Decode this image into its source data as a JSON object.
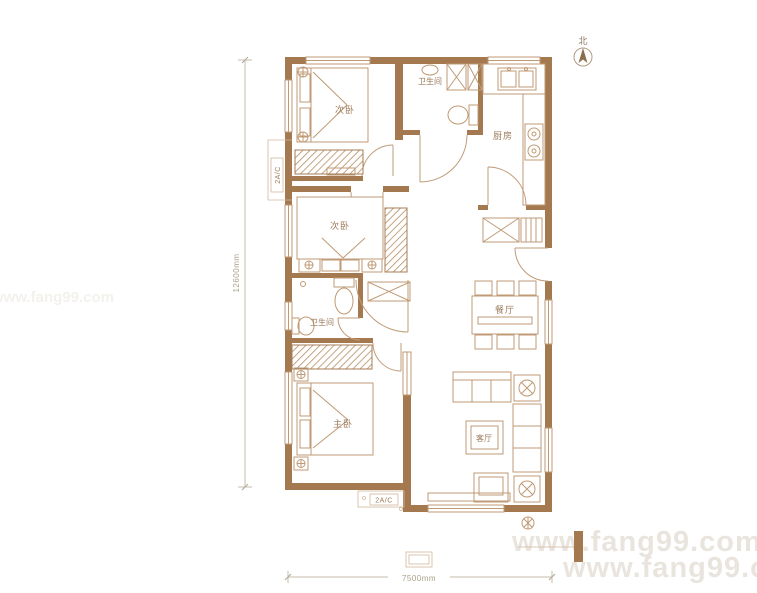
{
  "compass": {
    "label": "北"
  },
  "rooms": {
    "bedroom_top": {
      "label": "次卧"
    },
    "bathroom_top": {
      "label": "卫生间"
    },
    "kitchen": {
      "label": "厨房"
    },
    "bedroom_mid": {
      "label": "次卧"
    },
    "bathroom_mid": {
      "label": "卫生间"
    },
    "master_bedroom": {
      "label": "主卧"
    },
    "dining_room": {
      "label": "餐厅"
    },
    "living_room": {
      "label": "客厅"
    }
  },
  "annotations": {
    "ac_left": "2A/C",
    "ac_bottom": "2A/C"
  },
  "dimensions": {
    "vertical": "12600mm",
    "horizontal": "7500mm"
  },
  "watermarks": {
    "bottom_line1": "www.fang99.com",
    "bottom_line2": "www.fang99.co",
    "side_faint": "www.fang99.com"
  },
  "colors": {
    "wall": "#a47950",
    "furniture_line": "#bf9a74",
    "label_text": "#9b7a5a",
    "dimension_text": "#aba188",
    "watermark": "#e9e5de"
  }
}
